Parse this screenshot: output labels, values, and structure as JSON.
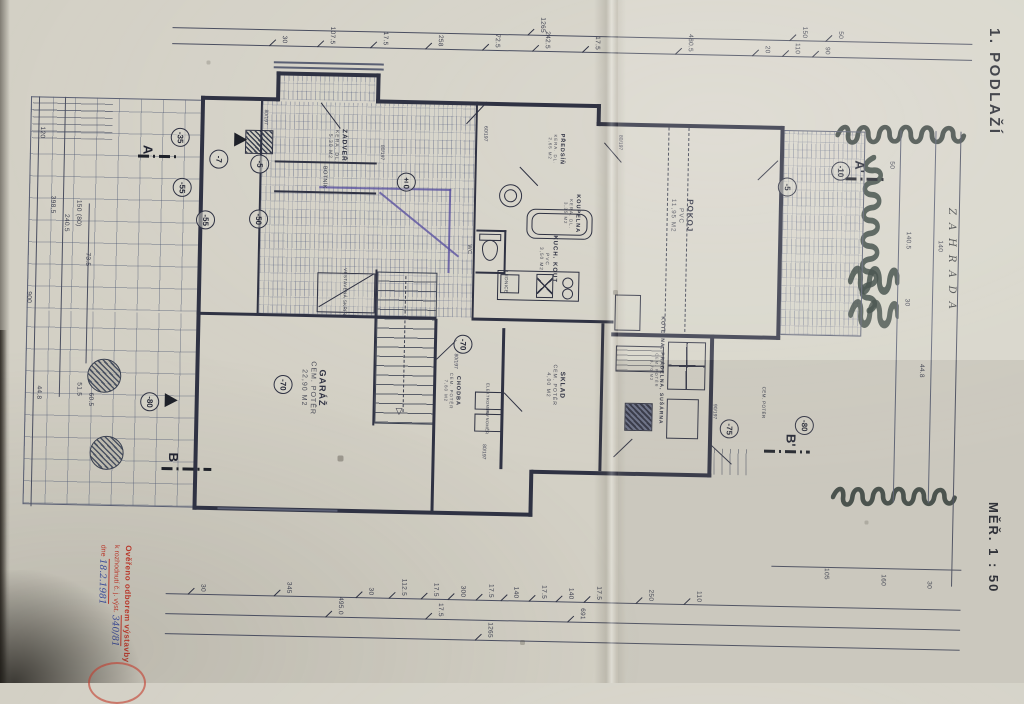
{
  "document": {
    "floor_title": "1. PODLAŽÍ",
    "scale": "MĚŘ. 1 : 50",
    "garden": "ZAHRADA"
  },
  "stamp": {
    "line1": "Ověřeno odborem výstavby",
    "line2": "k rozhodnutí č. j. výst.",
    "line2_number": "340/81",
    "line3_prefix": "dne",
    "line3_date": "18.2.1981"
  },
  "rooms": [
    {
      "id": "zadveri",
      "name": "ZÁDVEŘÍ",
      "finish": "KERA. DL.",
      "area": "5,30 M2",
      "x": 317,
      "y": 88,
      "s": 6.5
    },
    {
      "id": "predsin",
      "name": "PŘEDSÍŇ",
      "finish": "KERA. DL.",
      "area": "2,65 M2",
      "x": 536,
      "y": 86,
      "s": 5.5
    },
    {
      "id": "koupelna",
      "name": "KOUPELNA",
      "finish": "KERA. DL.",
      "area": "3,35 M2",
      "x": 553,
      "y": 150,
      "s": 5.5
    },
    {
      "id": "kuch-kout",
      "name": "KUCH. KOUT",
      "finish": "PVC",
      "area": "3,50 M2",
      "x": 530,
      "y": 196,
      "s": 6
    },
    {
      "id": "pokoj",
      "name": "POKOJ",
      "finish": "PVC",
      "area": "11,95 M2",
      "x": 663,
      "y": 150,
      "s": 8
    },
    {
      "id": "garaz",
      "name": "GARÁŽ",
      "finish": "CEM. POTĚR",
      "area": "22,90 M2",
      "x": 298,
      "y": 330,
      "s": 9
    },
    {
      "id": "chodba",
      "name": "CHODBA",
      "finish": "CEM. POTĚR",
      "area": "7,80 M2",
      "x": 437,
      "y": 330,
      "s": 5.5
    },
    {
      "id": "sklad",
      "name": "SKLAD",
      "finish": "CEM. POTĚR",
      "area": "4,00 M2",
      "x": 540,
      "y": 322,
      "s": 6.5
    },
    {
      "id": "kotelna",
      "name": "KOTELNA, PRÁDELNA, SUŠÁRNA",
      "finish": "CEM. POTĚR",
      "area": "9,70 M2",
      "x": 641,
      "y": 305,
      "s": 5
    }
  ],
  "small_labels": [
    {
      "t": "BOTNÍK",
      "x": 305,
      "y": 119,
      "s": 5.5
    },
    {
      "t": "VESTAVĚNÁ SKŘÍŇ",
      "x": 328,
      "y": 233,
      "s": 4.5
    },
    {
      "t": "LEDNICE",
      "x": 489,
      "y": 220,
      "s": 4.5
    },
    {
      "t": "ELEKTROMĚR",
      "x": 473,
      "y": 337,
      "s": 4
    },
    {
      "t": "PLYNOMĚR",
      "x": 473,
      "y": 360,
      "s": 4
    },
    {
      "t": "WC",
      "x": 451,
      "y": 188,
      "s": 5.5
    },
    {
      "t": "CEM. POTĚR",
      "x": 749,
      "y": 335,
      "s": 4.5
    }
  ],
  "levels": [
    {
      "v": "-35",
      "x": 160,
      "y": 82
    },
    {
      "v": "-7",
      "x": 199,
      "y": 103
    },
    {
      "v": "-5",
      "x": 240,
      "y": 107
    },
    {
      "v": "-55",
      "x": 163,
      "y": 132
    },
    {
      "v": "-55",
      "x": 187,
      "y": 164
    },
    {
      "v": "-50",
      "x": 240,
      "y": 162
    },
    {
      "v": "±0",
      "x": 387,
      "y": 122
    },
    {
      "v": "-5",
      "x": 768,
      "y": 119
    },
    {
      "v": "-10",
      "x": 821,
      "y": 102
    },
    {
      "v": "-70",
      "x": 268,
      "y": 327
    },
    {
      "v": "-70",
      "x": 447,
      "y": 283
    },
    {
      "v": "-75",
      "x": 715,
      "y": 362
    },
    {
      "v": "-80",
      "x": 135,
      "y": 347
    },
    {
      "v": "-80",
      "x": 790,
      "y": 357
    }
  ],
  "sections": [
    {
      "l": "A",
      "x": 128,
      "y": 95
    },
    {
      "l": "A'",
      "x": 840,
      "y": 97
    },
    {
      "l": "B",
      "x": 160,
      "y": 402
    },
    {
      "l": "B'",
      "x": 777,
      "y": 372
    }
  ],
  "door_labels": [
    {
      "t": "80/197",
      "x": 245,
      "y": 60
    },
    {
      "t": "80/197",
      "x": 362,
      "y": 93
    },
    {
      "t": "60/197",
      "x": 465,
      "y": 72
    },
    {
      "t": "80/197",
      "x": 600,
      "y": 78
    },
    {
      "t": "80/197",
      "x": 440,
      "y": 300
    },
    {
      "t": "90/197",
      "x": 700,
      "y": 345
    },
    {
      "t": "80/197",
      "x": 470,
      "y": 390
    }
  ],
  "dimensions": {
    "top1": [
      {
        "t": "30",
        "x": 262
      },
      {
        "t": "107.5",
        "x": 310
      },
      {
        "t": "17.5",
        "x": 363
      },
      {
        "t": "258",
        "x": 418
      },
      {
        "t": "72.5",
        "x": 475
      },
      {
        "t": "242.5",
        "x": 525
      },
      {
        "t": "17.5",
        "x": 575
      },
      {
        "t": "480.5",
        "x": 668
      },
      {
        "t": "20",
        "x": 745
      },
      {
        "t": "110",
        "x": 775
      },
      {
        "t": "90",
        "x": 805
      }
    ],
    "top2": [
      {
        "t": "1265",
        "x": 520
      },
      {
        "t": "150",
        "x": 782
      },
      {
        "t": "50",
        "x": 818
      }
    ],
    "bot1": [
      {
        "t": "30",
        "x": 192
      },
      {
        "t": "345",
        "x": 278
      },
      {
        "t": "30",
        "x": 360
      },
      {
        "t": "112.5",
        "x": 393
      },
      {
        "t": "17.5",
        "x": 425
      },
      {
        "t": "300",
        "x": 452
      },
      {
        "t": "17.5",
        "x": 480
      },
      {
        "t": "140",
        "x": 505
      },
      {
        "t": "17.5",
        "x": 533
      },
      {
        "t": "140",
        "x": 560
      },
      {
        "t": "17.5",
        "x": 588
      },
      {
        "t": "250",
        "x": 640
      },
      {
        "t": "110",
        "x": 688
      }
    ],
    "bot2": [
      {
        "t": "495.0",
        "x": 330
      },
      {
        "t": "17.5",
        "x": 430
      },
      {
        "t": "691",
        "x": 572
      }
    ],
    "bot3": [
      {
        "t": "1265",
        "x": 480
      }
    ],
    "left": [
      {
        "t": "120",
        "x": 22,
        "y": 80
      },
      {
        "t": "398.5",
        "x": 34,
        "y": 152
      },
      {
        "t": "240.5",
        "x": 48,
        "y": 170
      },
      {
        "t": "150 (80)",
        "x": 60,
        "y": 160
      },
      {
        "t": "73.5",
        "x": 70,
        "y": 206
      },
      {
        "t": "900",
        "x": 12,
        "y": 245
      },
      {
        "t": "44.8",
        "x": 24,
        "y": 340
      },
      {
        "t": "51.5",
        "x": 64,
        "y": 336
      },
      {
        "t": "60.5",
        "x": 76,
        "y": 346
      }
    ],
    "right": [
      {
        "t": "50",
        "x": 872,
        "y": 95
      },
      {
        "t": "140.5",
        "x": 890,
        "y": 170
      },
      {
        "t": "30",
        "x": 890,
        "y": 232
      },
      {
        "t": "44.8",
        "x": 906,
        "y": 300
      },
      {
        "t": "140",
        "x": 922,
        "y": 175
      },
      {
        "t": "105",
        "x": 815,
        "y": 505
      },
      {
        "t": "160",
        "x": 872,
        "y": 510
      },
      {
        "t": "30",
        "x": 918,
        "y": 514
      }
    ]
  }
}
